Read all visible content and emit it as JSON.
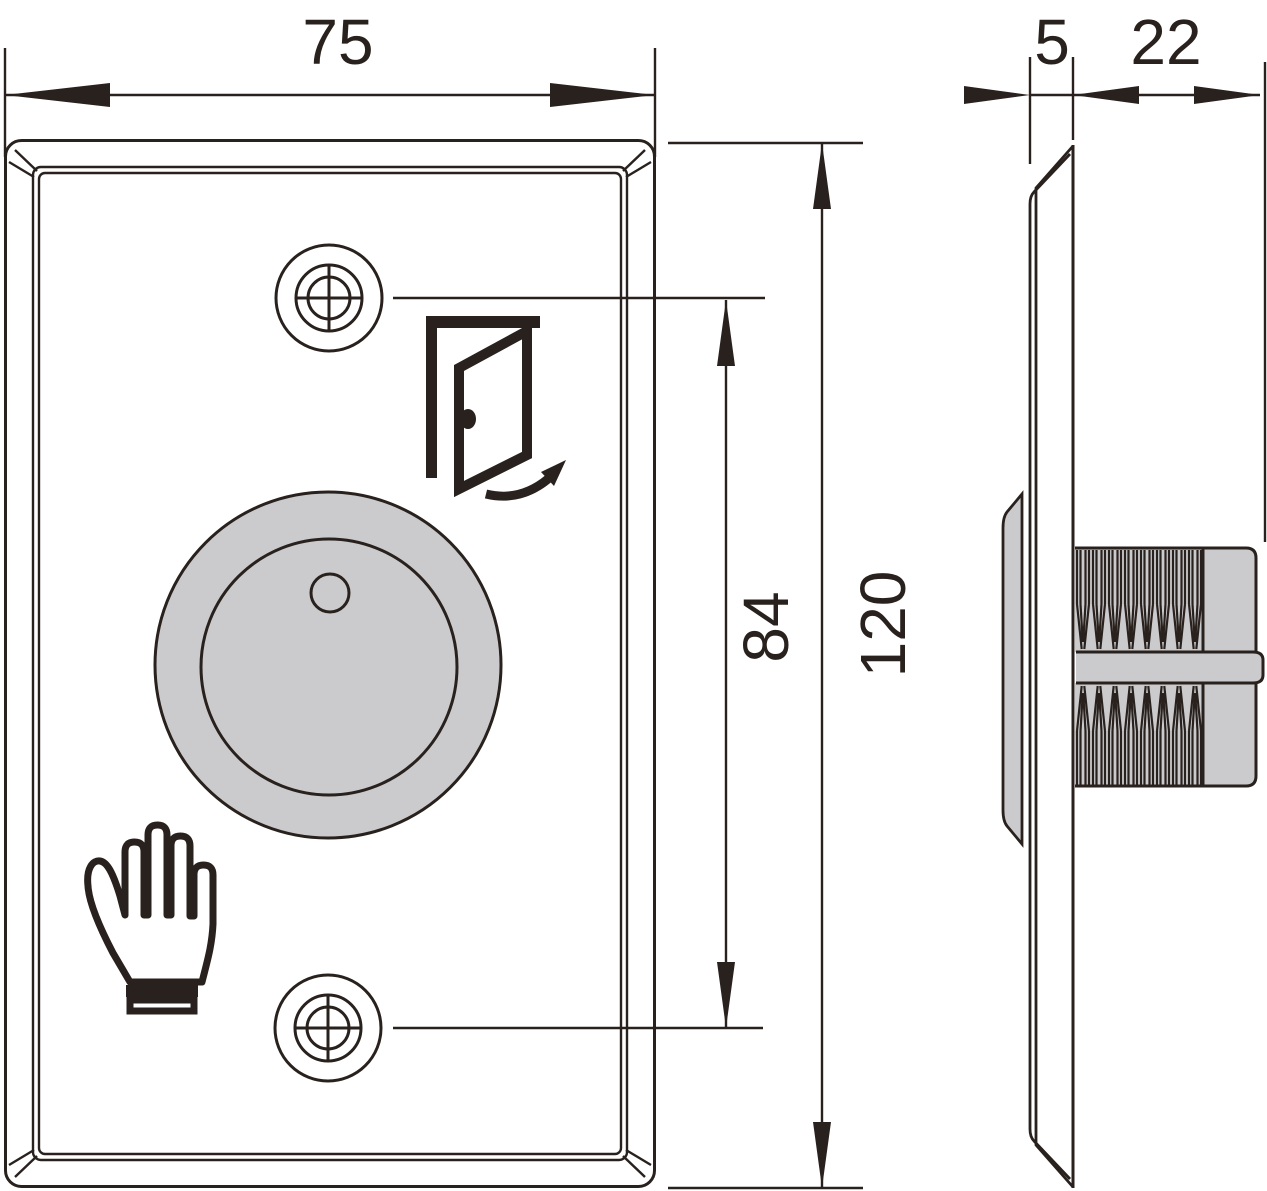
{
  "drawing": {
    "dims": {
      "plate_width": "75",
      "plate_thickness": "5",
      "barrel_length": "22",
      "hole_spacing": "84",
      "plate_height": "120"
    },
    "colors": {
      "line": "#29211d",
      "gray_fill": "#cbcbcd",
      "background": "#ffffff"
    },
    "icons": [
      "door-open-icon",
      "hand-icon",
      "screw-hole-crosshair-icon"
    ]
  }
}
